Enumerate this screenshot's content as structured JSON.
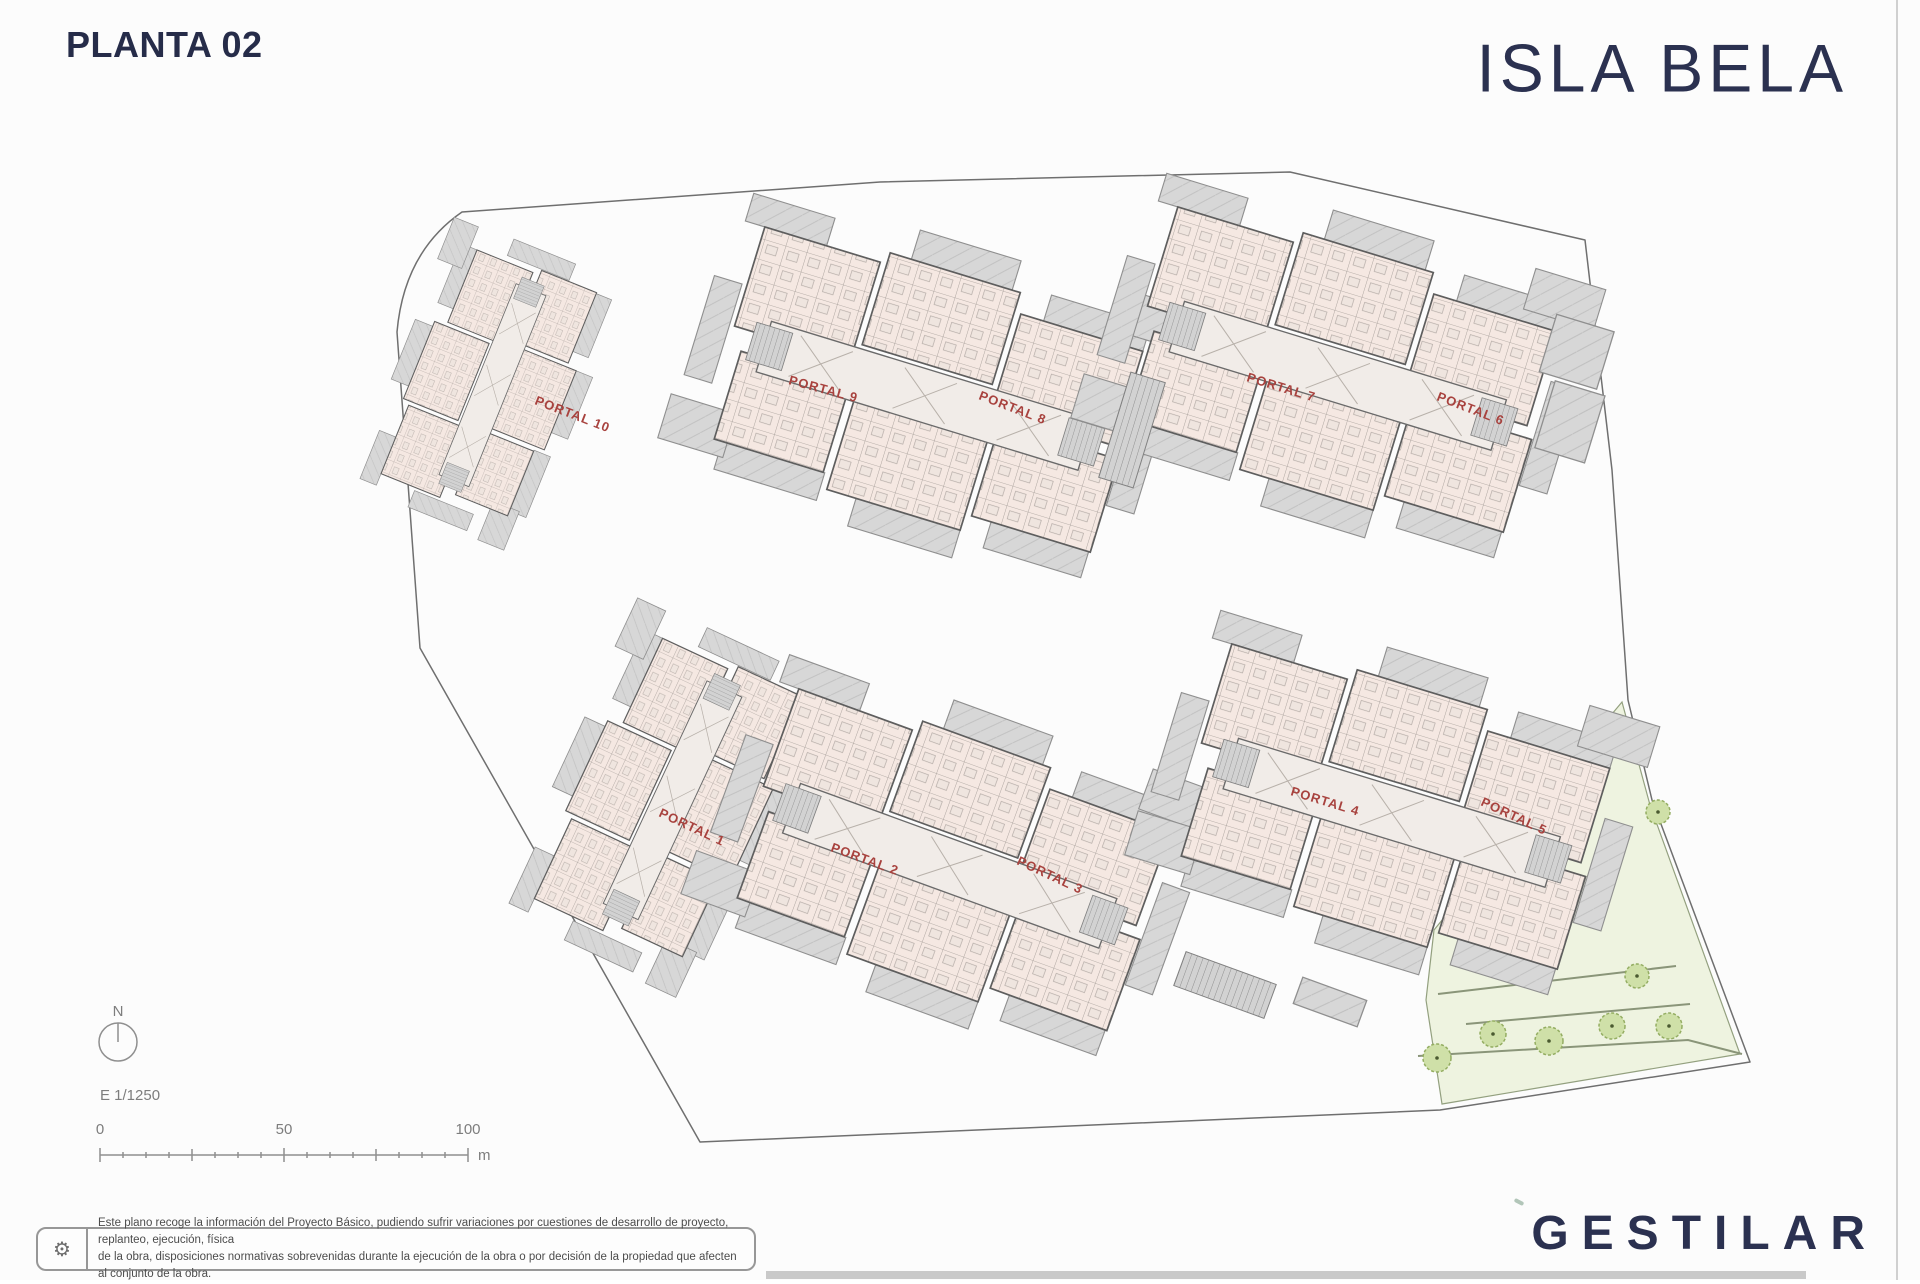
{
  "header": {
    "title": "PLANTA 02",
    "brand": "ISLA BELA"
  },
  "plan": {
    "portals": [
      {
        "label": "PORTAL 1"
      },
      {
        "label": "PORTAL 2"
      },
      {
        "label": "PORTAL 3"
      },
      {
        "label": "PORTAL 4"
      },
      {
        "label": "PORTAL 5"
      },
      {
        "label": "PORTAL 6"
      },
      {
        "label": "PORTAL 7"
      },
      {
        "label": "PORTAL 8"
      },
      {
        "label": "PORTAL 9"
      },
      {
        "label": "PORTAL 10"
      }
    ],
    "label_color": "#a8423e"
  },
  "compass": {
    "north_label": "N"
  },
  "scale": {
    "ratio": "E 1/1250",
    "tick_0": "0",
    "tick_50": "50",
    "tick_100": "100",
    "unit": "m"
  },
  "footer": {
    "disclaimer_icon": "⚙",
    "disclaimer_line1": "Este plano recoge la información del Proyecto Básico, pudiendo sufrir variaciones por cuestiones de desarrollo de proyecto, replanteo, ejecución, física",
    "disclaimer_line2": "de la obra, disposiciones normativas sobrevenidas durante la ejecución de la obra o por decisión de la propiedad que afecten al conjunto de la obra.",
    "brand": "GESTILAR"
  },
  "colors": {
    "navy": "#2b3150",
    "portal_red": "#a8423e",
    "apartment_fill": "#f5e8e2",
    "terrace_fill": "#d7d7d7",
    "green_fill": "#eef3e0"
  }
}
